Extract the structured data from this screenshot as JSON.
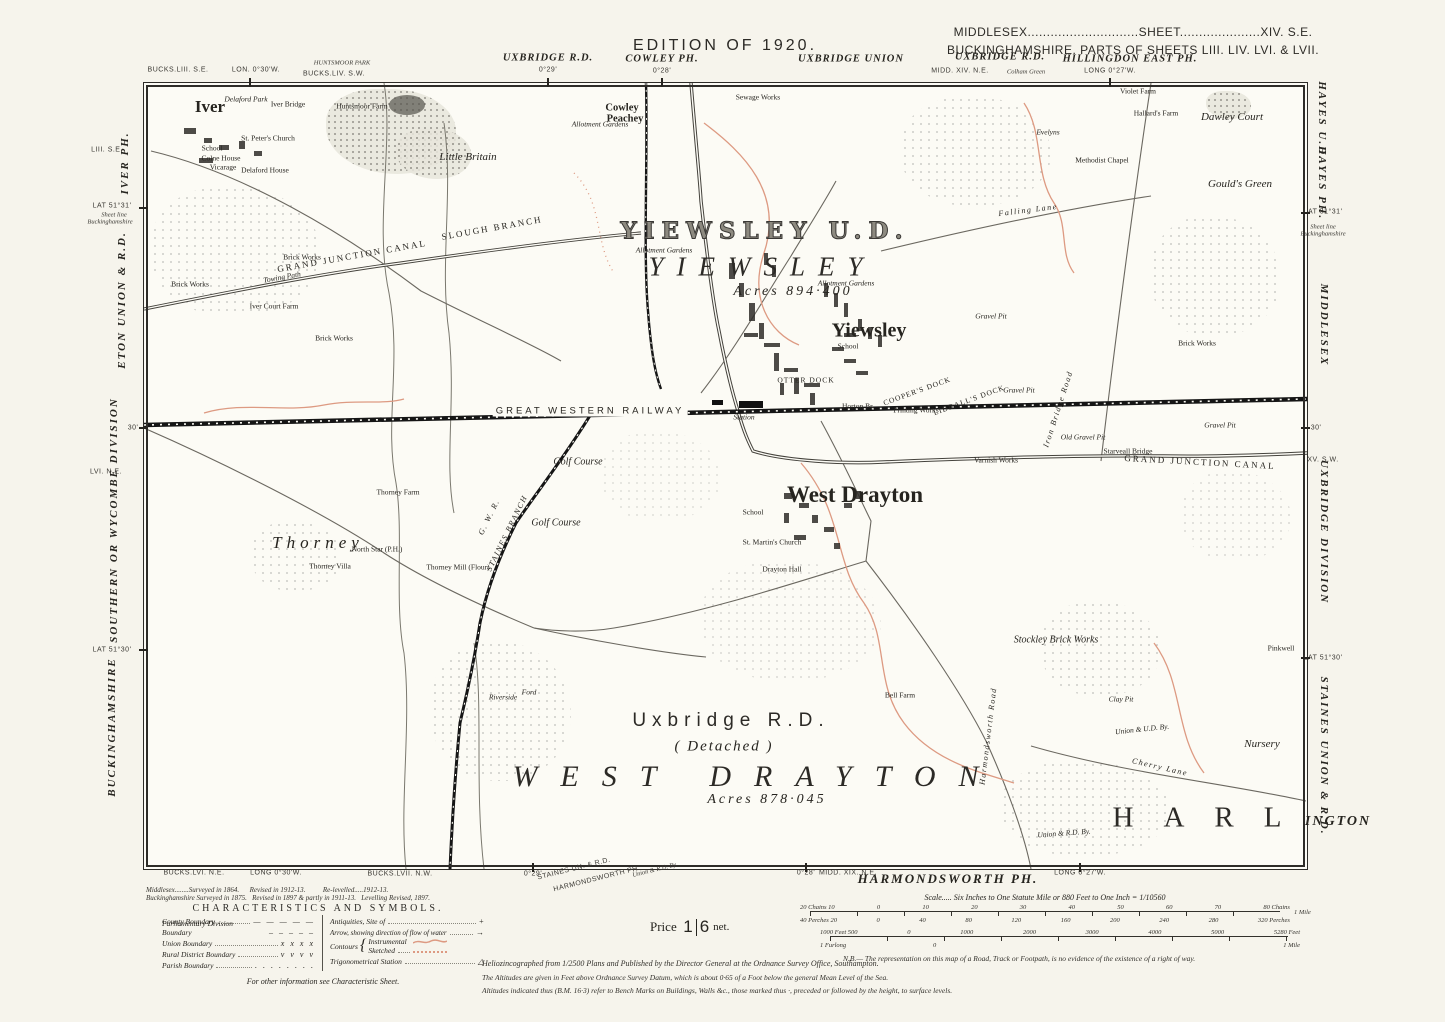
{
  "header": {
    "edition": "EDITION OF 1920.",
    "sheet_line1": "MIDDLESEX.............................SHEET.....................XIV. S.E.",
    "sheet_line2": "BUCKINGHAMSHIRE. PARTS OF SHEETS LIII. LIV. LVI. & LVII."
  },
  "colors": {
    "paper": "#f6f4ec",
    "map_bg": "#fcfbf5",
    "ink": "#26241f",
    "contour_red": "#dd9a82",
    "rail_black": "#151515"
  },
  "labels": [
    {
      "t": "EDITION OF 1920.",
      "x": 725,
      "y": 46,
      "c": "ed",
      "n": "edition-title"
    },
    {
      "t": "MIDDLESEX.............................SHEET.....................XIV. S.E.",
      "x": 1133,
      "y": 32,
      "c": "sh",
      "n": "sheet-ref-middlesex"
    },
    {
      "t": "BUCKINGHAMSHIRE. PARTS OF SHEETS LIII. LIV. LVI. & LVII.",
      "x": 1133,
      "y": 50,
      "c": "sh",
      "n": "sheet-ref-bucks"
    },
    {
      "t": "BUCKS.LIII. S.E.",
      "x": 178,
      "y": 70,
      "c": "mt"
    },
    {
      "t": "LON. 0°30'W.",
      "x": 256,
      "y": 70,
      "c": "mt"
    },
    {
      "t": "HUNTSMOOR PARK",
      "x": 342,
      "y": 63,
      "c": "mti"
    },
    {
      "t": "BUCKS.LIV. S.W.",
      "x": 334,
      "y": 74,
      "c": "mt"
    },
    {
      "t": "UXBRIDGE R.D.",
      "x": 548,
      "y": 58,
      "c": "mi"
    },
    {
      "t": "0°29'",
      "x": 548,
      "y": 70,
      "c": "mt"
    },
    {
      "t": "COWLEY PH.",
      "x": 662,
      "y": 59,
      "c": "mi"
    },
    {
      "t": "0°28'",
      "x": 662,
      "y": 71,
      "c": "mt"
    },
    {
      "t": "UXBRIDGE UNION",
      "x": 851,
      "y": 59,
      "c": "mi"
    },
    {
      "t": "UXBRIDGE R.D.",
      "x": 1000,
      "y": 57,
      "c": "mi"
    },
    {
      "t": "MIDD. XIV. N.E.",
      "x": 960,
      "y": 71,
      "c": "mt"
    },
    {
      "t": "Colham Green",
      "x": 1026,
      "y": 72,
      "c": "mti"
    },
    {
      "t": "HILLINGDON EAST PH.",
      "x": 1130,
      "y": 59,
      "c": "mi"
    },
    {
      "t": "LONG 0°27'W.",
      "x": 1110,
      "y": 71,
      "c": "mt"
    },
    {
      "t": "LIII. S.E.",
      "x": 107,
      "y": 150,
      "c": "mt"
    },
    {
      "t": "IVER PH.",
      "x": 125,
      "y": 163,
      "c": "mr",
      "r": -90
    },
    {
      "t": "LAT 51°31'",
      "x": 112,
      "y": 206,
      "c": "mt"
    },
    {
      "t": "Sheet line",
      "x": 114,
      "y": 215,
      "c": "mti"
    },
    {
      "t": "Buckinghamshire",
      "x": 110,
      "y": 222,
      "c": "mti"
    },
    {
      "t": "ETON UNION & R.D.",
      "x": 122,
      "y": 300,
      "c": "mr",
      "r": -90
    },
    {
      "t": "30'",
      "x": 133,
      "y": 428,
      "c": "mt"
    },
    {
      "t": "LVI. N.E.",
      "x": 106,
      "y": 472,
      "c": "mt"
    },
    {
      "t": "SOUTHERN OR WYCOMBE DIVISION",
      "x": 114,
      "y": 520,
      "c": "mr",
      "r": -90
    },
    {
      "t": "LAT 51°30'",
      "x": 112,
      "y": 650,
      "c": "mt"
    },
    {
      "t": "BUCKINGHAMSHIRE",
      "x": 112,
      "y": 727,
      "c": "mr",
      "r": -90
    },
    {
      "t": "HAYES U.D.",
      "x": 1322,
      "y": 121,
      "c": "mr",
      "r": 90
    },
    {
      "t": "HAYES PH.",
      "x": 1322,
      "y": 183,
      "c": "mr",
      "r": 90
    },
    {
      "t": "LAT 51°31'",
      "x": 1323,
      "y": 212,
      "c": "mt"
    },
    {
      "t": "Sheet line",
      "x": 1323,
      "y": 227,
      "c": "mti"
    },
    {
      "t": "Buckinghamshire",
      "x": 1323,
      "y": 234,
      "c": "mti"
    },
    {
      "t": "MIDDLESEX",
      "x": 1324,
      "y": 325,
      "c": "mr",
      "r": 90
    },
    {
      "t": "30'",
      "x": 1316,
      "y": 428,
      "c": "mt"
    },
    {
      "t": "XV. S.W.",
      "x": 1323,
      "y": 460,
      "c": "mt"
    },
    {
      "t": "UXBRIDGE DIVISION",
      "x": 1324,
      "y": 532,
      "c": "mr",
      "r": 90
    },
    {
      "t": "LAT 51°30'",
      "x": 1323,
      "y": 658,
      "c": "mt"
    },
    {
      "t": "STAINES UNION & R.D.",
      "x": 1324,
      "y": 756,
      "c": "mr",
      "r": 90
    },
    {
      "t": "INGTON",
      "x": 1338,
      "y": 822,
      "c": "ington"
    },
    {
      "t": "BUCKS.LVI. N.E.",
      "x": 194,
      "y": 873,
      "c": "mt"
    },
    {
      "t": "LONG 0°30'W.",
      "x": 276,
      "y": 873,
      "c": "mt"
    },
    {
      "t": "BUCKS.LVII. N.W.",
      "x": 400,
      "y": 874,
      "c": "mt"
    },
    {
      "t": "0°29'",
      "x": 533,
      "y": 874,
      "c": "mt"
    },
    {
      "t": "STAINES UN. & R.D.",
      "x": 574,
      "y": 869,
      "c": "mt",
      "r": -14
    },
    {
      "t": "HARMONDSWORTH PH.",
      "x": 597,
      "y": 879,
      "c": "mt",
      "r": -14
    },
    {
      "t": "Union & R.D. By.",
      "x": 655,
      "y": 870,
      "c": "mti",
      "r": -14
    },
    {
      "t": "0°28'",
      "x": 806,
      "y": 873,
      "c": "mt"
    },
    {
      "t": "MIDD. XIX. N.E.",
      "x": 848,
      "y": 873,
      "c": "mt"
    },
    {
      "t": "HARMONDSWORTH PH.",
      "x": 948,
      "y": 879,
      "c": "bigph"
    },
    {
      "t": "LONG 0°27'W.",
      "x": 1080,
      "y": 873,
      "c": "mt"
    },
    {
      "t": "Iver",
      "x": 210,
      "y": 107,
      "c": "town1"
    },
    {
      "t": "School",
      "x": 212,
      "y": 148,
      "c": "t"
    },
    {
      "t": "Colne House",
      "x": 221,
      "y": 158,
      "c": "t"
    },
    {
      "t": "Vicarage",
      "x": 223,
      "y": 167,
      "c": "t"
    },
    {
      "t": "St. Peter's Church",
      "x": 268,
      "y": 138,
      "c": "t"
    },
    {
      "t": "Delaford Park",
      "x": 246,
      "y": 99,
      "c": "ti"
    },
    {
      "t": "Iver Bridge",
      "x": 288,
      "y": 104,
      "c": "t"
    },
    {
      "t": "Delaford House",
      "x": 265,
      "y": 170,
      "c": "t"
    },
    {
      "t": "Huntsmoor Farm",
      "x": 362,
      "y": 106,
      "c": "t"
    },
    {
      "t": "Little Britain",
      "x": 468,
      "y": 157,
      "c": "hami"
    },
    {
      "t": "Cowley",
      "x": 622,
      "y": 108,
      "c": "ham"
    },
    {
      "t": "Peachey",
      "x": 625,
      "y": 119,
      "c": "ham"
    },
    {
      "t": "Sewage Works",
      "x": 758,
      "y": 97,
      "c": "t"
    },
    {
      "t": "Allotment Gardens",
      "x": 600,
      "y": 124,
      "c": "ti"
    },
    {
      "t": "Evelyns",
      "x": 1048,
      "y": 132,
      "c": "ti"
    },
    {
      "t": "Methodist Chapel",
      "x": 1102,
      "y": 160,
      "c": "t"
    },
    {
      "t": "Hallard's Farm",
      "x": 1156,
      "y": 113,
      "c": "t"
    },
    {
      "t": "Violet Farm",
      "x": 1138,
      "y": 91,
      "c": "t"
    },
    {
      "t": "Dawley Court",
      "x": 1232,
      "y": 117,
      "c": "hami"
    },
    {
      "t": "Gould's Green",
      "x": 1240,
      "y": 184,
      "c": "hami"
    },
    {
      "t": "Brick Works",
      "x": 302,
      "y": 257,
      "c": "t"
    },
    {
      "t": "Brick Works",
      "x": 190,
      "y": 284,
      "c": "t"
    },
    {
      "t": "Brick Works",
      "x": 334,
      "y": 338,
      "c": "t"
    },
    {
      "t": "Iver Court Farm",
      "x": 274,
      "y": 306,
      "c": "t"
    },
    {
      "t": "Brick Works",
      "x": 1197,
      "y": 343,
      "c": "t"
    },
    {
      "t": "GRAND JUNCTION CANAL",
      "x": 352,
      "y": 256,
      "c": "canal",
      "r": -10
    },
    {
      "t": "SLOUGH BRANCH",
      "x": 492,
      "y": 228,
      "c": "canal",
      "r": -10
    },
    {
      "t": "Towing Path",
      "x": 282,
      "y": 277,
      "c": "ti",
      "r": -10
    },
    {
      "t": "Falling Lane",
      "x": 1028,
      "y": 210,
      "c": "rdlbl",
      "r": -7
    },
    {
      "t": "YIEWSLEY U.D.",
      "x": 765,
      "y": 231,
      "c": "open"
    },
    {
      "t": "YIEWSLEY",
      "x": 762,
      "y": 267,
      "c": "giant"
    },
    {
      "t": "Acres 894·400",
      "x": 793,
      "y": 292,
      "c": "acres"
    },
    {
      "t": "Allotment Gardens",
      "x": 664,
      "y": 250,
      "c": "ti"
    },
    {
      "t": "Allotment Gardens",
      "x": 846,
      "y": 283,
      "c": "ti"
    },
    {
      "t": "Yiewsley",
      "x": 869,
      "y": 331,
      "c": "town2"
    },
    {
      "t": "School",
      "x": 848,
      "y": 346,
      "c": "t"
    },
    {
      "t": "OTTER DOCK",
      "x": 806,
      "y": 380,
      "c": "dock"
    },
    {
      "t": "COOPER'S DOCK",
      "x": 917,
      "y": 391,
      "c": "dock",
      "r": -20
    },
    {
      "t": "LIDDALL'S DOCK",
      "x": 969,
      "y": 400,
      "c": "dock",
      "r": -20
    },
    {
      "t": "Printing Works",
      "x": 916,
      "y": 410,
      "c": "t"
    },
    {
      "t": "Horton Br.",
      "x": 858,
      "y": 406,
      "c": "t"
    },
    {
      "t": "Gravel Pit",
      "x": 991,
      "y": 316,
      "c": "ti"
    },
    {
      "t": "Gravel Pit",
      "x": 1019,
      "y": 390,
      "c": "ti"
    },
    {
      "t": "GREAT WESTERN RAILWAY",
      "x": 590,
      "y": 411,
      "c": "rail"
    },
    {
      "t": "Station",
      "x": 744,
      "y": 417,
      "c": "ti"
    },
    {
      "t": "Varnish Works",
      "x": 996,
      "y": 460,
      "c": "t"
    },
    {
      "t": "GRAND JUNCTION CANAL",
      "x": 1200,
      "y": 462,
      "c": "canal",
      "r": 3
    },
    {
      "t": "Starveall Bridge",
      "x": 1128,
      "y": 451,
      "c": "t"
    },
    {
      "t": "Old Gravel Pit",
      "x": 1083,
      "y": 437,
      "c": "ti"
    },
    {
      "t": "Gravel Pit",
      "x": 1220,
      "y": 425,
      "c": "ti"
    },
    {
      "t": "Iron Bridge Road",
      "x": 1058,
      "y": 409,
      "c": "rdlbl",
      "r": -72
    },
    {
      "t": "Golf Course",
      "x": 578,
      "y": 462,
      "c": "golf"
    },
    {
      "t": "Golf Course",
      "x": 556,
      "y": 523,
      "c": "golf"
    },
    {
      "t": "West Drayton",
      "x": 855,
      "y": 495,
      "c": "town3"
    },
    {
      "t": "School",
      "x": 753,
      "y": 512,
      "c": "t"
    },
    {
      "t": "St. Martin's Church",
      "x": 772,
      "y": 542,
      "c": "t"
    },
    {
      "t": "Drayton Hall",
      "x": 782,
      "y": 569,
      "c": "t"
    },
    {
      "t": "Thorney",
      "x": 318,
      "y": 543,
      "c": "thorney"
    },
    {
      "t": "Thorney Farm",
      "x": 398,
      "y": 492,
      "c": "t"
    },
    {
      "t": "North Star (P.H.)",
      "x": 377,
      "y": 549,
      "c": "t"
    },
    {
      "t": "Thorney Villa",
      "x": 330,
      "y": 566,
      "c": "t"
    },
    {
      "t": "Thorney Mill (Flour)",
      "x": 458,
      "y": 567,
      "c": "t"
    },
    {
      "t": "G. W. R.",
      "x": 489,
      "y": 517,
      "c": "rdlbl",
      "r": -64
    },
    {
      "t": "STAINES BRANCH",
      "x": 507,
      "y": 533,
      "c": "rdlbl",
      "r": -64
    },
    {
      "t": "Ford",
      "x": 529,
      "y": 692,
      "c": "ti"
    },
    {
      "t": "Riverside",
      "x": 503,
      "y": 697,
      "c": "ti"
    },
    {
      "t": "Uxbridge R.D.",
      "x": 731,
      "y": 721,
      "c": "rd"
    },
    {
      "t": "( Detached )",
      "x": 724,
      "y": 747,
      "c": "det"
    },
    {
      "t": "WEST DRAYTON",
      "x": 757,
      "y": 777,
      "c": "giant2"
    },
    {
      "t": "Acres 878·045",
      "x": 767,
      "y": 800,
      "c": "acres"
    },
    {
      "t": "Harmondsworth Road",
      "x": 988,
      "y": 736,
      "c": "rdlbl",
      "r": -83
    },
    {
      "t": "Bell Farm",
      "x": 900,
      "y": 695,
      "c": "t"
    },
    {
      "t": "Stockley Brick Works",
      "x": 1056,
      "y": 640,
      "c": "ti2"
    },
    {
      "t": "Clay Pit",
      "x": 1121,
      "y": 699,
      "c": "ti"
    },
    {
      "t": "Union & U.D. By.",
      "x": 1142,
      "y": 729,
      "c": "ti",
      "r": -6
    },
    {
      "t": "Cherry Lane",
      "x": 1160,
      "y": 767,
      "c": "rdlbl",
      "r": 13
    },
    {
      "t": "Nursery",
      "x": 1262,
      "y": 744,
      "c": "hami"
    },
    {
      "t": "Pinkwell",
      "x": 1281,
      "y": 648,
      "c": "t"
    },
    {
      "t": "Union & R.D. By.",
      "x": 1064,
      "y": 833,
      "c": "ti",
      "r": -4
    },
    {
      "t": "HARL",
      "x": 1212,
      "y": 818,
      "c": "harl"
    }
  ],
  "legend": {
    "survey_line1": "Middlesex........Surveyed in 1864.      Revised in 1912-13.          Re-levelled.....1912-13.",
    "survey_line2": "Buckinghamshire Surveyed in 1875.   Revised in 1897 & partly in 1911-13.   Levelling Revised, 1897.",
    "title": "CHARACTERISTICS AND SYMBOLS.",
    "rows_left": [
      {
        "label": "County Boundary",
        "sym": "— — — — —"
      },
      {
        "label": "Parliamentary Division Boundary",
        "sym": "– – – – –"
      },
      {
        "label": "Union Boundary",
        "sym": "x  x  x  x"
      },
      {
        "label": "Rural District Boundary",
        "sym": "v  v  v  v"
      },
      {
        "label": "Parish Boundary",
        "sym": ". . . . . . . ."
      }
    ],
    "antiquities_label": "Antiquities, Site of",
    "antiquities_sym": "+",
    "arrow_label": "Arrow, showing direction of flow of water",
    "arrow_sym": "→",
    "contours_label": "Contours",
    "contours_instrumental": "Instrumental",
    "contours_sketched": "Sketched",
    "trig_label": "Trigonometrical Station",
    "trig_sym": "△",
    "footnote": "For other information see Characteristic Sheet."
  },
  "price": {
    "word": "Price",
    "num": "1",
    "den": "6",
    "net": "net."
  },
  "scale": {
    "caption": "Scale..... Six Inches to One Statute Mile or 880 Feet to One Inch = 1/10560",
    "bar1_top": [
      "20 Chains 10",
      "0",
      "10",
      "20",
      "30",
      "40",
      "50",
      "60",
      "70",
      "80 Chains"
    ],
    "bar1_bottom": [
      "40 Perches 20",
      "0",
      "40",
      "80",
      "120",
      "160",
      "200",
      "240",
      "280",
      "320 Perches"
    ],
    "bar1_right": "1 Mile",
    "bar2_top": [
      "1000 Feet 500",
      "0",
      "1000",
      "2000",
      "3000",
      "4000",
      "5000",
      "5280 Feet"
    ],
    "bar2_bottom": [
      "1 Furlong",
      "0",
      "",
      "",
      "",
      "1 Mile"
    ],
    "nb": "N.B.— The representation on this map of a Road, Track or Footpath, is no evidence of the existence of a right of way."
  },
  "imprint": {
    "line1": "Heliozincographed from 1/2500 Plans and Published by the Director General at the Ordnance Survey Office, Southampton.",
    "line2": "The Altitudes are given in Feet above Ordnance Survey Datum, which is about 0·65 of a Foot below the general Mean Level of the Sea.",
    "line3": "Altitudes indicated thus (B.M. 16·3) refer to Bench Marks on Buildings, Walls &c., those marked thus ·, preceded or followed by the height, to surface levels."
  }
}
